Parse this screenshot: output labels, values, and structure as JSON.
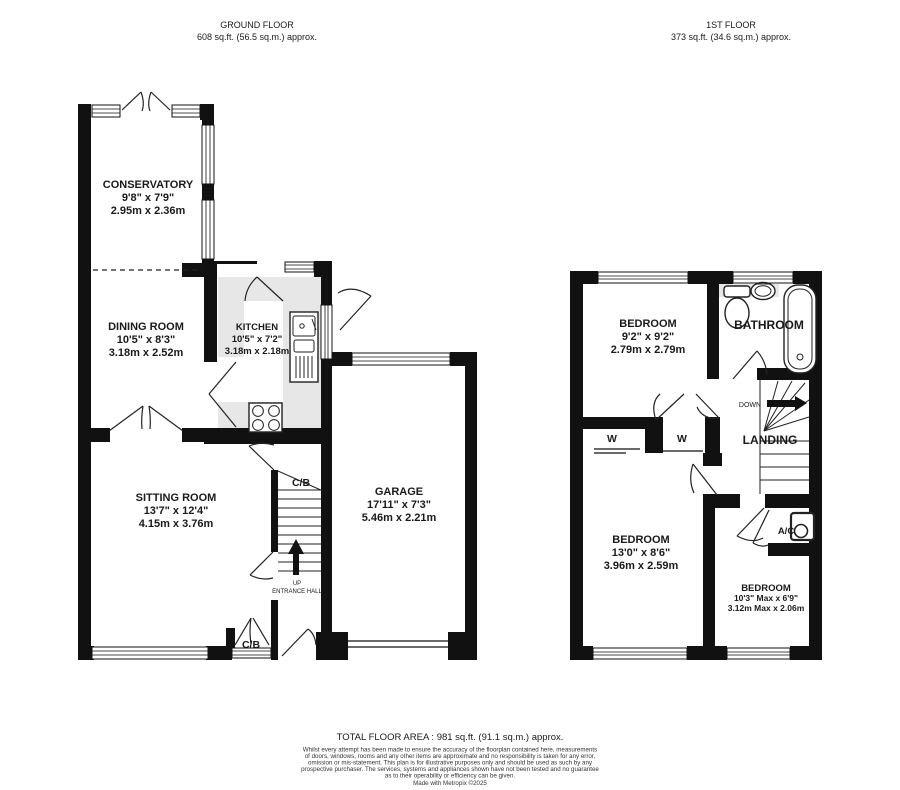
{
  "headers": {
    "ground": {
      "title": "GROUND FLOOR",
      "area": "608 sq.ft. (56.5 sq.m.) approx."
    },
    "first": {
      "title": "1ST FLOOR",
      "area": "373 sq.ft. (34.6 sq.m.) approx."
    }
  },
  "ground": {
    "conservatory": {
      "name": "CONSERVATORY",
      "imperial": "9'8\"  x 7'9\"",
      "metric": "2.95m  x 2.36m"
    },
    "dining": {
      "name": "DINING ROOM",
      "imperial": "10'5\"  x 8'3\"",
      "metric": "3.18m  x 2.52m"
    },
    "kitchen": {
      "name": "KITCHEN",
      "imperial": "10'5\"  x 7'2\"",
      "metric": "3.18m  x 2.18m"
    },
    "sitting": {
      "name": "SITTING ROOM",
      "imperial": "13'7\"  x 12'4\"",
      "metric": "4.15m  x 3.76m"
    },
    "garage": {
      "name": "GARAGE",
      "imperial": "17'11\"  x 7'3\"",
      "metric": "5.46m  x 2.21m"
    },
    "entrance_hall": "ENTRANCE HALL",
    "up": "UP",
    "cb_stairs": "C/B",
    "cb_front": "C/B"
  },
  "first": {
    "bedroom1": {
      "name": "BEDROOM",
      "imperial": "9'2\"  x 9'2\"",
      "metric": "2.79m  x 2.79m"
    },
    "bedroom2": {
      "name": "BEDROOM",
      "imperial": "13'0\"  x 8'6\"",
      "metric": "3.96m  x 2.59m"
    },
    "bedroom3": {
      "name": "BEDROOM",
      "imperial": "10'3\" Max x 6'9\"",
      "metric": "3.12m Max x 2.06m"
    },
    "bathroom": "BATHROOM",
    "landing": "LANDING",
    "down": "DOWN",
    "wardrobe_left": "W",
    "wardrobe_right": "W",
    "airing_cupboard": "A/C"
  },
  "footer": {
    "total": "TOTAL FLOOR AREA : 981 sq.ft. (91.1 sq.m.) approx.",
    "disclaimer": [
      "Whilst every attempt has been made to ensure the accuracy of the floorplan contained here, measurements",
      "of doors, windows, rooms and any other items are approximate and no responsibility is taken for any error,",
      "omission or mis-statement. This plan is for illustrative purposes only and should be used as such by any",
      "prospective purchaser. The services, systems and appliances shown have not been tested and no guarantee",
      "as to their operability or efficiency can be given."
    ],
    "credit": "Made with Metropix ©2025"
  },
  "colors": {
    "wall": "#111111",
    "counter": "#e7e7e7",
    "text": "#1a1a1a"
  }
}
